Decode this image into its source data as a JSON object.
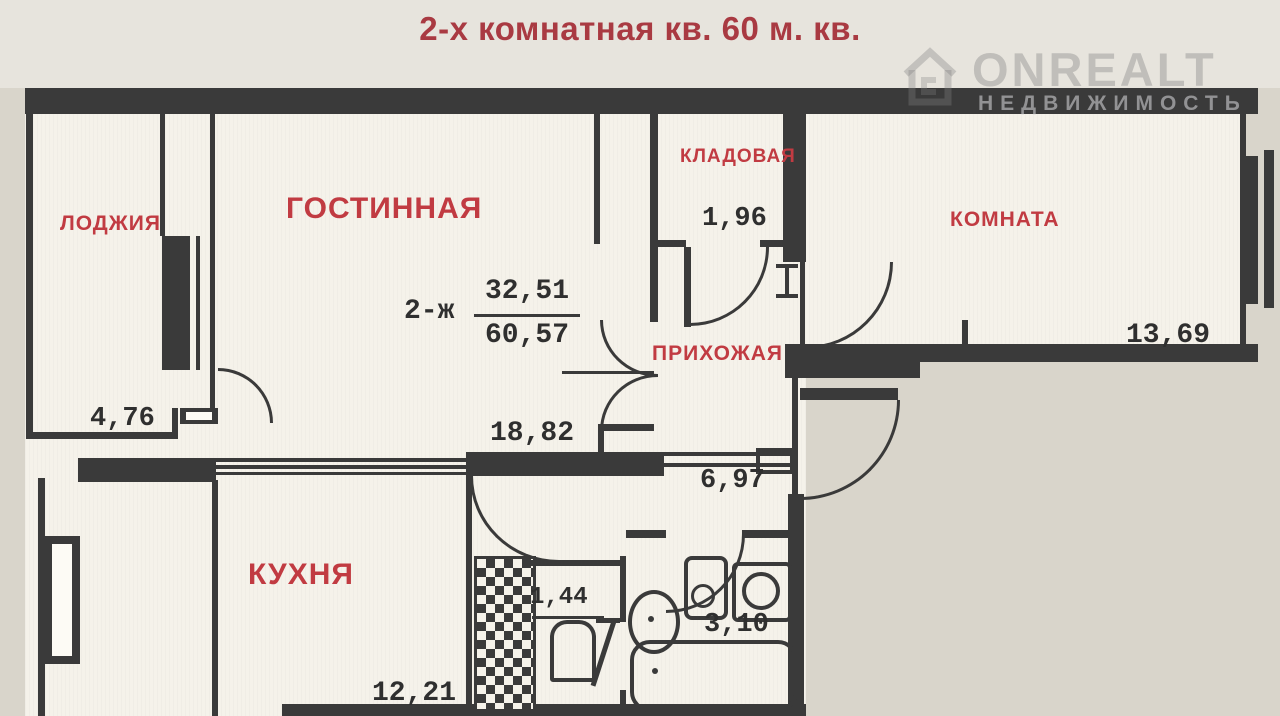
{
  "photo": {
    "title": "2-х комнатная кв. 60 м. кв.",
    "watermark": {
      "brand": "ONREALT",
      "subtitle": "НЕДВИЖИМОСТЬ"
    }
  },
  "plan": {
    "designation": {
      "prefix": "2-ж",
      "living_area": "32,51",
      "total_area": "60,57"
    },
    "rooms": {
      "loggia": {
        "label": "ЛОДЖИЯ",
        "area": "4,76"
      },
      "living_room": {
        "label": "ГОСТИННАЯ",
        "area": "18,82"
      },
      "storage": {
        "label": "КЛАДОВАЯ",
        "area": "1,96"
      },
      "hallway": {
        "label": "ПРИХОЖАЯ",
        "area": "6,97"
      },
      "bedroom": {
        "label": "КОМНАТА",
        "area": "13,69"
      },
      "kitchen": {
        "label": "КУХНЯ",
        "area": "12,21"
      },
      "wc": {
        "area": "1,44"
      },
      "bathroom": {
        "area": "3,10"
      }
    },
    "colors": {
      "wall": "#3a3a3a",
      "label_red": "#c13b42",
      "title_red": "#a93a42",
      "digits": "#2f2f2f",
      "paper": "#f5f2ea"
    }
  }
}
